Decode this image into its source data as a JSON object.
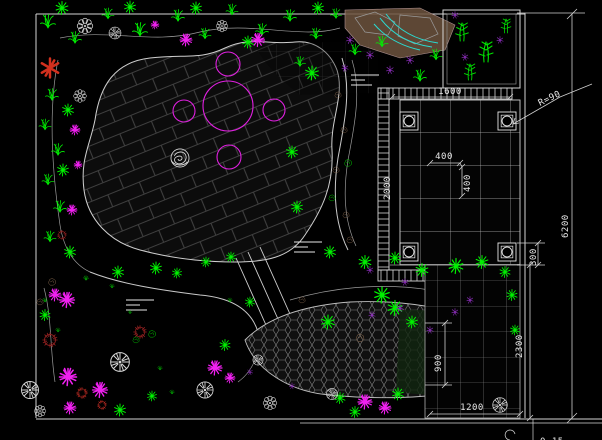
{
  "drawing": {
    "background": "#000000",
    "kind": "garden landscape plan (CAD)",
    "line_color": "#d5d5d5"
  },
  "palette": {
    "plant_green": "#00f000",
    "magenta": "#f020f0",
    "purple": "#9932cc",
    "red_flower": "#d2301e",
    "dark_red_shrub": "#902020",
    "rock_brown": "#8b6b50",
    "water_cyan": "#2adbd2",
    "paving_line": "#3f3f3f",
    "white_line": "#d5d5d5"
  },
  "dims": {
    "width_1600": "1600",
    "radius": "R=90",
    "tile_w": "400",
    "tile_h": "400",
    "depth_2000": "2000",
    "offset_300": "300",
    "width_900": "900",
    "length_1200": "1200",
    "height_2300": "2300",
    "height_6200": "6200",
    "level": "0.15"
  },
  "water_marks": [
    {
      "x": 365,
      "y": 80
    },
    {
      "x": 308,
      "y": 247
    },
    {
      "x": 140,
      "y": 305
    }
  ],
  "plants": [
    {
      "t": "fern",
      "x": 48,
      "y": 22,
      "s": 15,
      "c": "#00f000"
    },
    {
      "t": "fern",
      "x": 75,
      "y": 38,
      "s": 13,
      "c": "#00f000"
    },
    {
      "t": "fern",
      "x": 108,
      "y": 14,
      "s": 12,
      "c": "#00f000"
    },
    {
      "t": "fern",
      "x": 140,
      "y": 30,
      "s": 15,
      "c": "#00f000"
    },
    {
      "t": "fern",
      "x": 178,
      "y": 16,
      "s": 13,
      "c": "#00f000"
    },
    {
      "t": "fern",
      "x": 205,
      "y": 34,
      "s": 12,
      "c": "#00f000"
    },
    {
      "t": "fern",
      "x": 232,
      "y": 10,
      "s": 12,
      "c": "#00f000"
    },
    {
      "t": "fern",
      "x": 262,
      "y": 30,
      "s": 13,
      "c": "#00f000"
    },
    {
      "t": "fern",
      "x": 290,
      "y": 16,
      "s": 13,
      "c": "#00f000"
    },
    {
      "t": "fern",
      "x": 316,
      "y": 34,
      "s": 12,
      "c": "#00f000"
    },
    {
      "t": "fern",
      "x": 336,
      "y": 14,
      "s": 11,
      "c": "#00f000"
    },
    {
      "t": "fern",
      "x": 52,
      "y": 95,
      "s": 13,
      "c": "#00f000"
    },
    {
      "t": "fern",
      "x": 45,
      "y": 125,
      "s": 12,
      "c": "#00f000"
    },
    {
      "t": "fern",
      "x": 58,
      "y": 150,
      "s": 13,
      "c": "#00f000"
    },
    {
      "t": "fern",
      "x": 48,
      "y": 180,
      "s": 12,
      "c": "#00f000"
    },
    {
      "t": "fern",
      "x": 60,
      "y": 207,
      "s": 13,
      "c": "#00f000"
    },
    {
      "t": "fern",
      "x": 50,
      "y": 237,
      "s": 12,
      "c": "#00f000"
    },
    {
      "t": "fern",
      "x": 355,
      "y": 50,
      "s": 12,
      "c": "#00f000"
    },
    {
      "t": "fern",
      "x": 382,
      "y": 42,
      "s": 12,
      "c": "#00f000"
    },
    {
      "t": "fern",
      "x": 420,
      "y": 76,
      "s": 13,
      "c": "#00f000"
    },
    {
      "t": "fern",
      "x": 436,
      "y": 55,
      "s": 12,
      "c": "#00f000"
    },
    {
      "t": "fern",
      "x": 300,
      "y": 62,
      "s": 11,
      "c": "#00f000"
    },
    {
      "t": "star",
      "x": 62,
      "y": 8,
      "s": 13,
      "c": "#00f000"
    },
    {
      "t": "star",
      "x": 130,
      "y": 7,
      "s": 12,
      "c": "#00f000"
    },
    {
      "t": "star",
      "x": 196,
      "y": 8,
      "s": 12,
      "c": "#00f000"
    },
    {
      "t": "star",
      "x": 248,
      "y": 42,
      "s": 12,
      "c": "#00f000"
    },
    {
      "t": "star",
      "x": 318,
      "y": 8,
      "s": 12,
      "c": "#00f000"
    },
    {
      "t": "star",
      "x": 68,
      "y": 110,
      "s": 12,
      "c": "#00f000"
    },
    {
      "t": "star",
      "x": 63,
      "y": 170,
      "s": 12,
      "c": "#00f000"
    },
    {
      "t": "star",
      "x": 70,
      "y": 252,
      "s": 12,
      "c": "#00f000"
    },
    {
      "t": "star",
      "x": 118,
      "y": 272,
      "s": 12,
      "c": "#00f000"
    },
    {
      "t": "star",
      "x": 156,
      "y": 268,
      "s": 12,
      "c": "#00f000"
    },
    {
      "t": "star",
      "x": 177,
      "y": 273,
      "s": 10,
      "c": "#00f000"
    },
    {
      "t": "star",
      "x": 206,
      "y": 262,
      "s": 10,
      "c": "#00f000"
    },
    {
      "t": "star",
      "x": 231,
      "y": 257,
      "s": 10,
      "c": "#00f000"
    },
    {
      "t": "star",
      "x": 312,
      "y": 73,
      "s": 14,
      "c": "#00f000"
    },
    {
      "t": "star",
      "x": 292,
      "y": 152,
      "s": 12,
      "c": "#00f000"
    },
    {
      "t": "star",
      "x": 297,
      "y": 207,
      "s": 12,
      "c": "#00f000"
    },
    {
      "t": "star",
      "x": 330,
      "y": 252,
      "s": 12,
      "c": "#00f000"
    },
    {
      "t": "star",
      "x": 365,
      "y": 262,
      "s": 13,
      "c": "#00f000"
    },
    {
      "t": "star",
      "x": 395,
      "y": 258,
      "s": 12,
      "c": "#00f000"
    },
    {
      "t": "star",
      "x": 422,
      "y": 270,
      "s": 13,
      "c": "#00f000"
    },
    {
      "t": "star",
      "x": 456,
      "y": 266,
      "s": 15,
      "c": "#00f000"
    },
    {
      "t": "star",
      "x": 482,
      "y": 262,
      "s": 13,
      "c": "#00f000"
    },
    {
      "t": "star",
      "x": 505,
      "y": 272,
      "s": 11,
      "c": "#00f000"
    },
    {
      "t": "star",
      "x": 512,
      "y": 295,
      "s": 11,
      "c": "#00f000"
    },
    {
      "t": "star",
      "x": 515,
      "y": 330,
      "s": 10,
      "c": "#00f000"
    },
    {
      "t": "star",
      "x": 382,
      "y": 295,
      "s": 16,
      "c": "#00f000"
    },
    {
      "t": "star",
      "x": 412,
      "y": 322,
      "s": 12,
      "c": "#00f000"
    },
    {
      "t": "star",
      "x": 398,
      "y": 394,
      "s": 12,
      "c": "#00f000"
    },
    {
      "t": "star",
      "x": 340,
      "y": 398,
      "s": 11,
      "c": "#00f000"
    },
    {
      "t": "star",
      "x": 355,
      "y": 412,
      "s": 11,
      "c": "#00f000"
    },
    {
      "t": "star",
      "x": 225,
      "y": 345,
      "s": 11,
      "c": "#00f000"
    },
    {
      "t": "star",
      "x": 45,
      "y": 315,
      "s": 11,
      "c": "#00f000"
    },
    {
      "t": "star",
      "x": 120,
      "y": 410,
      "s": 12,
      "c": "#00f000"
    },
    {
      "t": "star",
      "x": 152,
      "y": 396,
      "s": 10,
      "c": "#00f000"
    },
    {
      "t": "star",
      "x": 250,
      "y": 302,
      "s": 10,
      "c": "#00f000"
    },
    {
      "t": "star",
      "x": 328,
      "y": 322,
      "s": 14,
      "c": "#00f000"
    },
    {
      "t": "star",
      "x": 395,
      "y": 308,
      "s": 15,
      "c": "#00f000"
    },
    {
      "t": "splash",
      "x": 155,
      "y": 25,
      "s": 8,
      "c": "#f020f0"
    },
    {
      "t": "splash",
      "x": 186,
      "y": 40,
      "s": 12,
      "c": "#f020f0"
    },
    {
      "t": "splash",
      "x": 258,
      "y": 40,
      "s": 13,
      "c": "#f020f0"
    },
    {
      "t": "splash",
      "x": 75,
      "y": 130,
      "s": 10,
      "c": "#f020f0"
    },
    {
      "t": "splash",
      "x": 72,
      "y": 210,
      "s": 10,
      "c": "#f020f0"
    },
    {
      "t": "splash",
      "x": 78,
      "y": 165,
      "s": 8,
      "c": "#f020f0"
    },
    {
      "t": "splash",
      "x": 55,
      "y": 295,
      "s": 12,
      "c": "#f020f0"
    },
    {
      "t": "splash",
      "x": 67,
      "y": 300,
      "s": 15,
      "c": "#f020f0"
    },
    {
      "t": "splash",
      "x": 68,
      "y": 377,
      "s": 17,
      "c": "#f020f0"
    },
    {
      "t": "splash",
      "x": 70,
      "y": 408,
      "s": 12,
      "c": "#f020f0"
    },
    {
      "t": "splash",
      "x": 100,
      "y": 390,
      "s": 15,
      "c": "#f020f0"
    },
    {
      "t": "splash",
      "x": 215,
      "y": 368,
      "s": 14,
      "c": "#f020f0"
    },
    {
      "t": "splash",
      "x": 365,
      "y": 402,
      "s": 14,
      "c": "#f020f0"
    },
    {
      "t": "splash",
      "x": 385,
      "y": 408,
      "s": 12,
      "c": "#f020f0"
    },
    {
      "t": "splash",
      "x": 230,
      "y": 378,
      "s": 10,
      "c": "#f020f0"
    },
    {
      "t": "purple",
      "x": 350,
      "y": 40,
      "s": 9,
      "c": "#9932cc"
    },
    {
      "t": "purple",
      "x": 370,
      "y": 55,
      "s": 9,
      "c": "#9932cc"
    },
    {
      "t": "purple",
      "x": 390,
      "y": 70,
      "s": 9,
      "c": "#9932cc"
    },
    {
      "t": "purple",
      "x": 410,
      "y": 60,
      "s": 9,
      "c": "#9932cc"
    },
    {
      "t": "purple",
      "x": 345,
      "y": 68,
      "s": 8,
      "c": "#9932cc"
    },
    {
      "t": "purple",
      "x": 400,
      "y": 308,
      "s": 9,
      "c": "#9932cc"
    },
    {
      "t": "purple",
      "x": 372,
      "y": 315,
      "s": 8,
      "c": "#9932cc"
    },
    {
      "t": "purple",
      "x": 430,
      "y": 330,
      "s": 8,
      "c": "#9932cc"
    },
    {
      "t": "purple",
      "x": 455,
      "y": 312,
      "s": 8,
      "c": "#9932cc"
    },
    {
      "t": "purple",
      "x": 370,
      "y": 270,
      "s": 8,
      "c": "#9932cc"
    },
    {
      "t": "purple",
      "x": 405,
      "y": 282,
      "s": 8,
      "c": "#9932cc"
    },
    {
      "t": "purple",
      "x": 470,
      "y": 300,
      "s": 8,
      "c": "#9932cc"
    },
    {
      "t": "purple",
      "x": 250,
      "y": 372,
      "s": 7,
      "c": "#9932cc"
    },
    {
      "t": "purple",
      "x": 292,
      "y": 386,
      "s": 7,
      "c": "#9932cc"
    },
    {
      "t": "purple",
      "x": 455,
      "y": 15,
      "s": 8,
      "c": "#9932cc"
    },
    {
      "t": "purple",
      "x": 500,
      "y": 40,
      "s": 8,
      "c": "#9932cc"
    },
    {
      "t": "purple",
      "x": 465,
      "y": 57,
      "s": 8,
      "c": "#9932cc"
    },
    {
      "t": "wheel",
      "x": 115,
      "y": 33,
      "s": 14,
      "c": "#d8d8d8"
    },
    {
      "t": "wheel",
      "x": 30,
      "y": 390,
      "s": 20,
      "c": "#d8d8d8"
    },
    {
      "t": "wheel",
      "x": 120,
      "y": 362,
      "s": 22,
      "c": "#d8d8d8"
    },
    {
      "t": "wheel",
      "x": 205,
      "y": 390,
      "s": 19,
      "c": "#d8d8d8"
    },
    {
      "t": "wheel",
      "x": 332,
      "y": 394,
      "s": 13,
      "c": "#d8d8d8"
    },
    {
      "t": "wheel",
      "x": 500,
      "y": 405,
      "s": 17,
      "c": "#d8d8d8"
    },
    {
      "t": "wheel",
      "x": 258,
      "y": 360,
      "s": 12,
      "c": "#d8d8d8"
    },
    {
      "t": "petal",
      "x": 85,
      "y": 26,
      "s": 16,
      "c": "#e0e0e0"
    },
    {
      "t": "petal",
      "x": 222,
      "y": 26,
      "s": 12,
      "c": "#e0e0e0"
    },
    {
      "t": "petal",
      "x": 80,
      "y": 96,
      "s": 13,
      "c": "#e0e0e0"
    },
    {
      "t": "petal",
      "x": 270,
      "y": 403,
      "s": 14,
      "c": "#e0e0e0"
    },
    {
      "t": "petal",
      "x": 40,
      "y": 411,
      "s": 12,
      "c": "#e0e0e0"
    },
    {
      "t": "redshrub",
      "x": 62,
      "y": 235,
      "s": 11,
      "c": "#902020"
    },
    {
      "t": "redshrub",
      "x": 50,
      "y": 340,
      "s": 17,
      "c": "#902020"
    },
    {
      "t": "redshrub",
      "x": 140,
      "y": 332,
      "s": 15,
      "c": "#902020"
    },
    {
      "t": "redshrub",
      "x": 82,
      "y": 393,
      "s": 13,
      "c": "#b02820"
    },
    {
      "t": "redshrub",
      "x": 102,
      "y": 405,
      "s": 11,
      "c": "#b02820"
    },
    {
      "t": "redstar",
      "x": 50,
      "y": 68,
      "s": 19,
      "c": "#d2301e"
    },
    {
      "t": "grass",
      "x": 86,
      "y": 278,
      "s": 8,
      "c": "#00d800"
    },
    {
      "t": "grass",
      "x": 112,
      "y": 286,
      "s": 7,
      "c": "#00d800"
    },
    {
      "t": "grass",
      "x": 58,
      "y": 330,
      "s": 7,
      "c": "#00d800"
    },
    {
      "t": "grass",
      "x": 160,
      "y": 368,
      "s": 7,
      "c": "#00d800"
    },
    {
      "t": "grass",
      "x": 230,
      "y": 300,
      "s": 7,
      "c": "#00d800"
    },
    {
      "t": "grass",
      "x": 45,
      "y": 300,
      "s": 7,
      "c": "#00d800"
    },
    {
      "t": "grass",
      "x": 172,
      "y": 392,
      "s": 7,
      "c": "#00d800"
    },
    {
      "t": "grass",
      "x": 130,
      "y": 312,
      "s": 6,
      "c": "#00d800"
    },
    {
      "t": "bamboo",
      "x": 462,
      "y": 32,
      "s": 18,
      "c": "#00e000"
    },
    {
      "t": "bamboo",
      "x": 486,
      "y": 52,
      "s": 20,
      "c": "#00e000"
    },
    {
      "t": "bamboo",
      "x": 470,
      "y": 72,
      "s": 16,
      "c": "#00e000"
    },
    {
      "t": "bamboo",
      "x": 506,
      "y": 26,
      "s": 14,
      "c": "#00e000"
    },
    {
      "t": "rock",
      "x": 338,
      "y": 95,
      "s": 8,
      "c": "#8b6b50"
    },
    {
      "t": "rock",
      "x": 344,
      "y": 130,
      "s": 8,
      "c": "#8b6b50"
    },
    {
      "t": "rock",
      "x": 336,
      "y": 170,
      "s": 8,
      "c": "#8b6b50"
    },
    {
      "t": "rock",
      "x": 346,
      "y": 215,
      "s": 8,
      "c": "#8b6b50"
    },
    {
      "t": "rock",
      "x": 350,
      "y": 240,
      "s": 8,
      "c": "#8b6b50"
    },
    {
      "t": "rock",
      "x": 360,
      "y": 338,
      "s": 10,
      "c": "#8b6b50"
    },
    {
      "t": "rock",
      "x": 52,
      "y": 282,
      "s": 9,
      "c": "#8b6b50"
    },
    {
      "t": "rock",
      "x": 40,
      "y": 302,
      "s": 8,
      "c": "#8b6b50"
    },
    {
      "t": "rock",
      "x": 302,
      "y": 300,
      "s": 8,
      "c": "#8b6b50"
    },
    {
      "t": "rock",
      "x": 136,
      "y": 340,
      "s": 8,
      "c": "#00d800"
    },
    {
      "t": "rock",
      "x": 152,
      "y": 334,
      "s": 9,
      "c": "#00d800"
    },
    {
      "t": "rock",
      "x": 348,
      "y": 163,
      "s": 9,
      "c": "#00d800"
    },
    {
      "t": "rock",
      "x": 332,
      "y": 198,
      "s": 8,
      "c": "#00d800"
    },
    {
      "t": "rockscribble",
      "x": 180,
      "y": 158,
      "s": 19,
      "c": "#dcdcdc"
    }
  ]
}
